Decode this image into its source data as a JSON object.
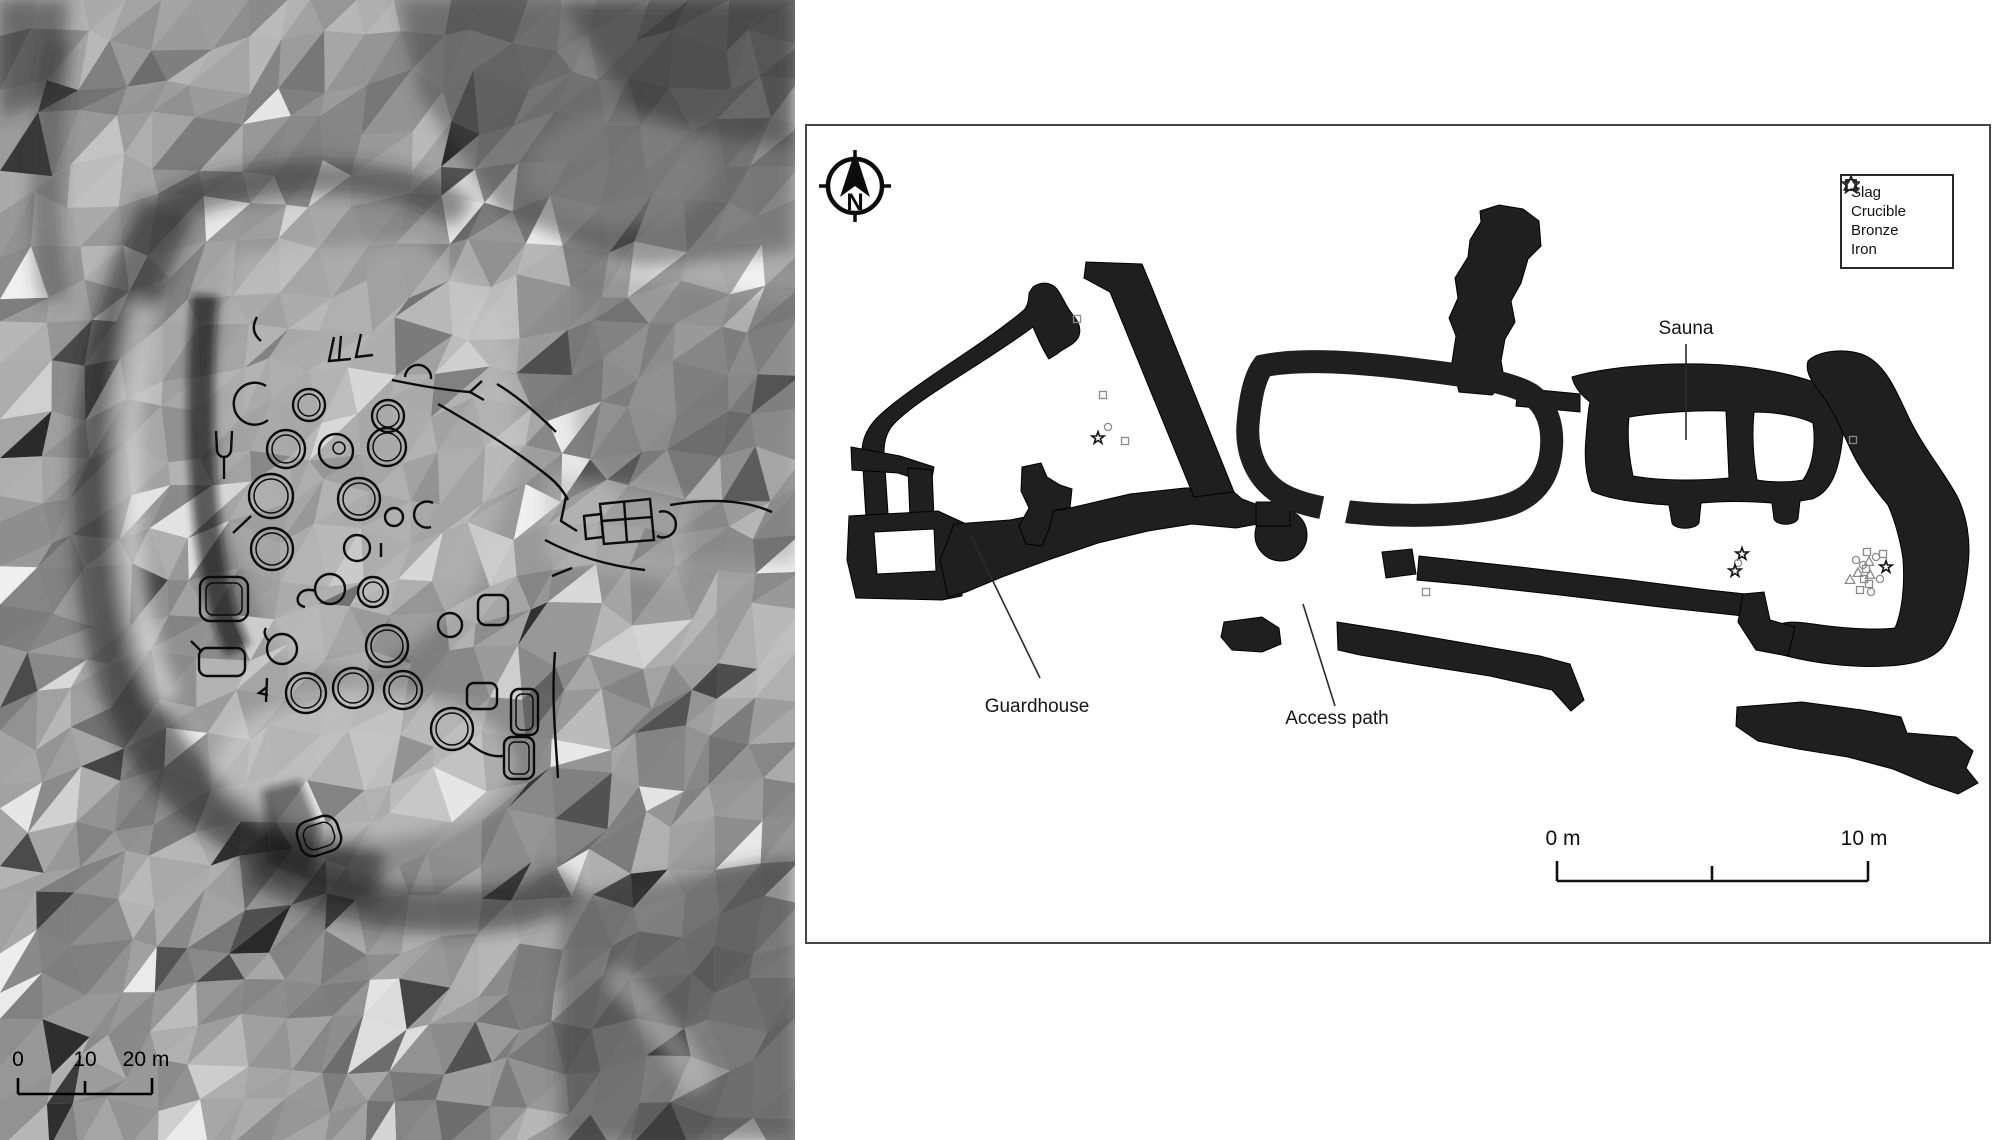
{
  "figure": {
    "left_panel": {
      "description": "lidar-hillshade-map",
      "scale_bar": {
        "t0": "0",
        "t10": "10",
        "t20": "20 m"
      }
    },
    "right_panel": {
      "description": "excavation-plan",
      "north_letter": "N",
      "legend": [
        {
          "type": "square",
          "label": "Slag"
        },
        {
          "type": "triangle",
          "label": "Crucible"
        },
        {
          "type": "circle",
          "label": "Bronze"
        },
        {
          "type": "star",
          "label": "Iron"
        }
      ],
      "labels": {
        "sauna": "Sauna",
        "guardhouse": "Guardhouse",
        "access_path": "Access path"
      },
      "scale_bar": {
        "start": "0 m",
        "end": "10 m"
      },
      "finds": [
        {
          "t": "square",
          "x": 1077,
          "y": 319,
          "c": "gray"
        },
        {
          "t": "square",
          "x": 1103,
          "y": 395,
          "c": "gray"
        },
        {
          "t": "circle",
          "x": 1108,
          "y": 427,
          "c": "gray"
        },
        {
          "t": "star",
          "x": 1098,
          "y": 438,
          "c": "black"
        },
        {
          "t": "square",
          "x": 1125,
          "y": 441,
          "c": "gray"
        },
        {
          "t": "square",
          "x": 1426,
          "y": 592,
          "c": "gray"
        },
        {
          "t": "square",
          "x": 1853,
          "y": 440,
          "c": "gray"
        },
        {
          "t": "star",
          "x": 1742,
          "y": 554,
          "c": "black"
        },
        {
          "t": "circle",
          "x": 1738,
          "y": 563,
          "c": "gray"
        },
        {
          "t": "star",
          "x": 1735,
          "y": 571,
          "c": "black"
        },
        {
          "t": "square",
          "x": 1867,
          "y": 552,
          "c": "gray"
        },
        {
          "t": "square",
          "x": 1883,
          "y": 554,
          "c": "gray"
        },
        {
          "t": "circle",
          "x": 1856,
          "y": 560,
          "c": "gray"
        },
        {
          "t": "circle",
          "x": 1876,
          "y": 557,
          "c": "gray"
        },
        {
          "t": "triangle",
          "x": 1869,
          "y": 562,
          "c": "gray"
        },
        {
          "t": "circle",
          "x": 1863,
          "y": 565,
          "c": "gray"
        },
        {
          "t": "star",
          "x": 1886,
          "y": 567,
          "c": "black"
        },
        {
          "t": "square",
          "x": 1866,
          "y": 569,
          "c": "gray"
        },
        {
          "t": "triangle",
          "x": 1858,
          "y": 573,
          "c": "gray"
        },
        {
          "t": "triangle",
          "x": 1870,
          "y": 575,
          "c": "gray"
        },
        {
          "t": "square",
          "x": 1864,
          "y": 579,
          "c": "gray"
        },
        {
          "t": "circle",
          "x": 1880,
          "y": 579,
          "c": "gray"
        },
        {
          "t": "triangle",
          "x": 1850,
          "y": 580,
          "c": "gray"
        },
        {
          "t": "square",
          "x": 1869,
          "y": 584,
          "c": "gray"
        },
        {
          "t": "square",
          "x": 1860,
          "y": 590,
          "c": "gray"
        },
        {
          "t": "circle",
          "x": 1871,
          "y": 592,
          "c": "gray"
        }
      ]
    },
    "colors": {
      "wall": "#1f1f1f",
      "marker_gray": "#8a8a8a",
      "marker_black": "#141414",
      "panel_border": "#454545"
    }
  }
}
